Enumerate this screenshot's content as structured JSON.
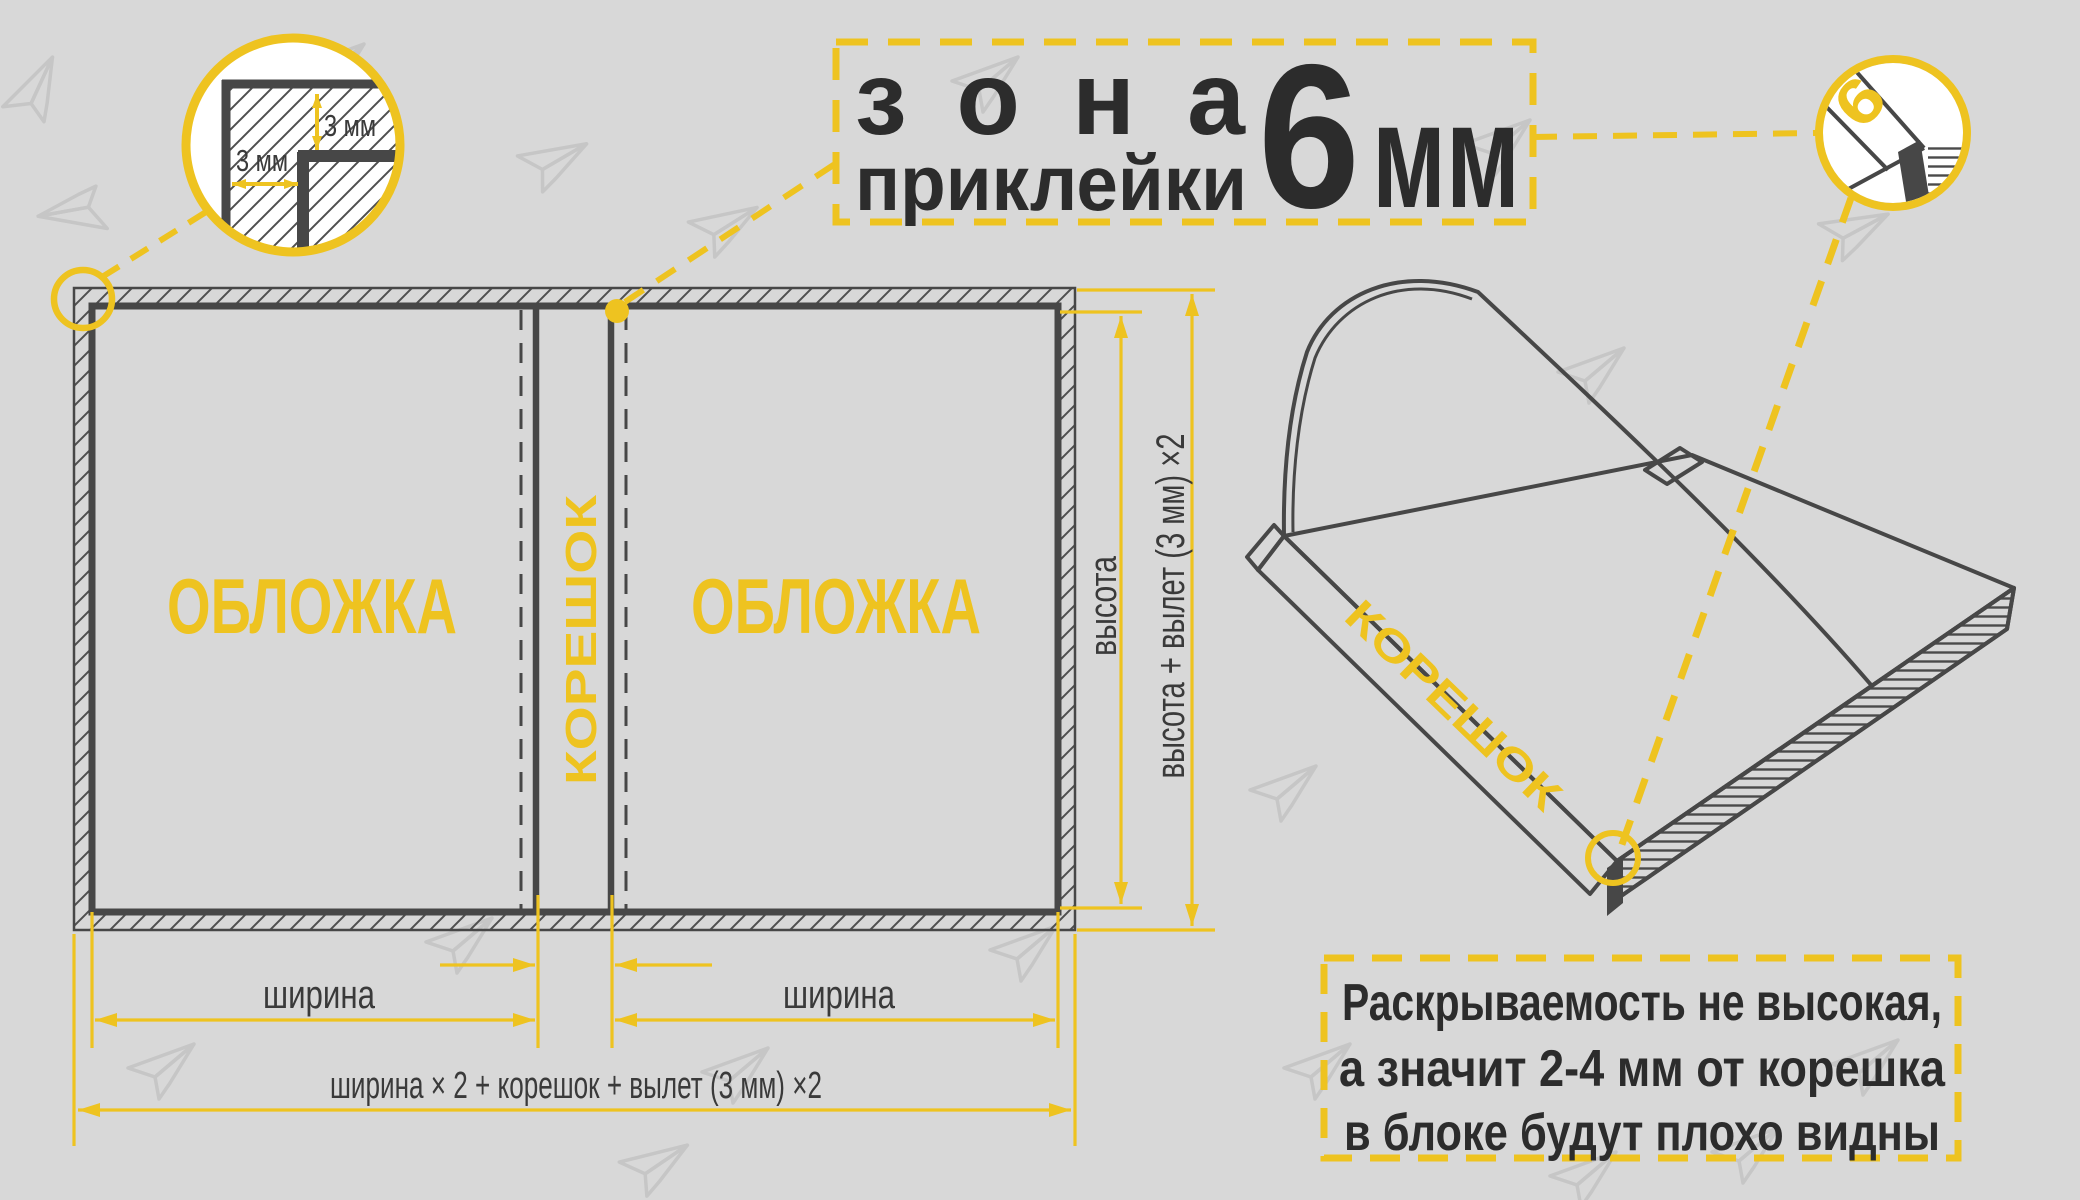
{
  "colors": {
    "background": "#d8d8d8",
    "accent_yellow": "#eec320",
    "line_dark": "#474747",
    "text_dark": "#2c2c2c",
    "watermark_gray": "#c6c6c6",
    "paper_white": "#ffffff"
  },
  "title": {
    "word1": "зона",
    "word2": "приклейки",
    "number": "6",
    "unit": "мм"
  },
  "corner_detail": {
    "label_vertical": "3 мм",
    "label_horizontal": "3 мм"
  },
  "spread": {
    "cover_left": "ОБЛОЖКА",
    "cover_right": "ОБЛОЖКА",
    "spine": "КОРЕШОК"
  },
  "dimensions": {
    "width_left": "ширина",
    "width_right": "ширина",
    "height": "высота",
    "height_full": "высота + вылет (3 мм) ×2",
    "width_full": "ширина × 2 + корешок + вылет (3 мм) ×2"
  },
  "book": {
    "spine_label": "КОРЕШОК",
    "glue_number": "6"
  },
  "note": {
    "line1": "Раскрываемость не высокая,",
    "line2": "а значит 2-4 мм от корешка",
    "line3": "в блоке будут плохо видны"
  }
}
